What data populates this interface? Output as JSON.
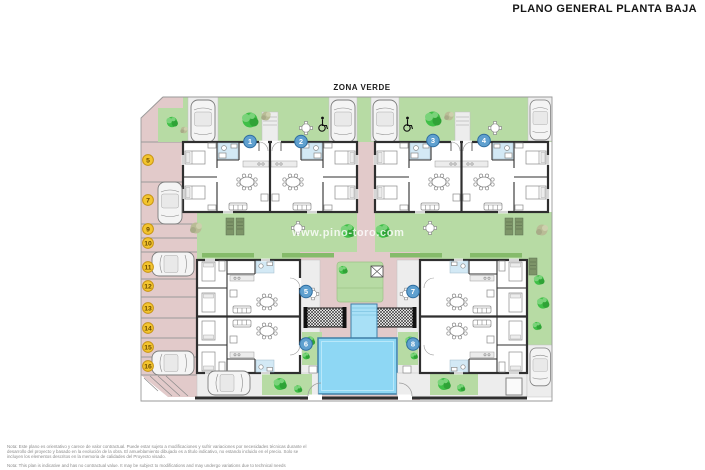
{
  "title": "PLANO GENERAL PLANTA BAJA",
  "plan": {
    "zone_label": "ZONA VERDE",
    "watermark": "www.pino-toro.com",
    "unit_markers": [
      "1",
      "2",
      "3",
      "4",
      "5",
      "6",
      "7",
      "8"
    ],
    "parking_markers": [
      "5",
      "7",
      "9",
      "10",
      "11",
      "12",
      "13",
      "14",
      "15",
      "16"
    ],
    "colors": {
      "green": "#b7dba4",
      "hedge": "#85bb6a",
      "pink": "#e2caca",
      "cream": "#f8f0d6",
      "wall": "#2f2f2f",
      "gray": "#ededed",
      "pool": "#8ed7f4",
      "pool_border": "#3f7fa6",
      "channel": "#a8e0f6",
      "tile": "#d3e9f5",
      "marker_blue": "#5fa0cf",
      "marker_blue_border": "#2e6da0",
      "marker_yellow": "#f3c52f",
      "marker_yellow_border": "#c79414",
      "tree": "#3fbf47",
      "tree_light": "#7ad37a",
      "tree_dark": "#2fa336",
      "olive": "#b9bc96",
      "car": "#f4f4f4",
      "lounger": "#7d9468",
      "watermark": "rgba(255,255,255,0.8)"
    }
  },
  "footer": {
    "note_es_1": "Nota: Este plano es orientativo y carece de valor contractual. Puede estar sujeto a modificaciones y sufrir variaciones por necesidades técnicas durante el",
    "note_es_2": "desarrollo del proyecto y basado en la evolución de la obra. El amueblamiento dibujado es a título indicativo, no estando incluido en el precio. Solo se",
    "note_es_3": "incluyen los elementos descritos en la memoria de calidades del Proyecto visado.",
    "note_en": "Nota: This plan is indicative and has no contractual value. It may be subject to modifications and may undergo variations due to technical needs"
  }
}
